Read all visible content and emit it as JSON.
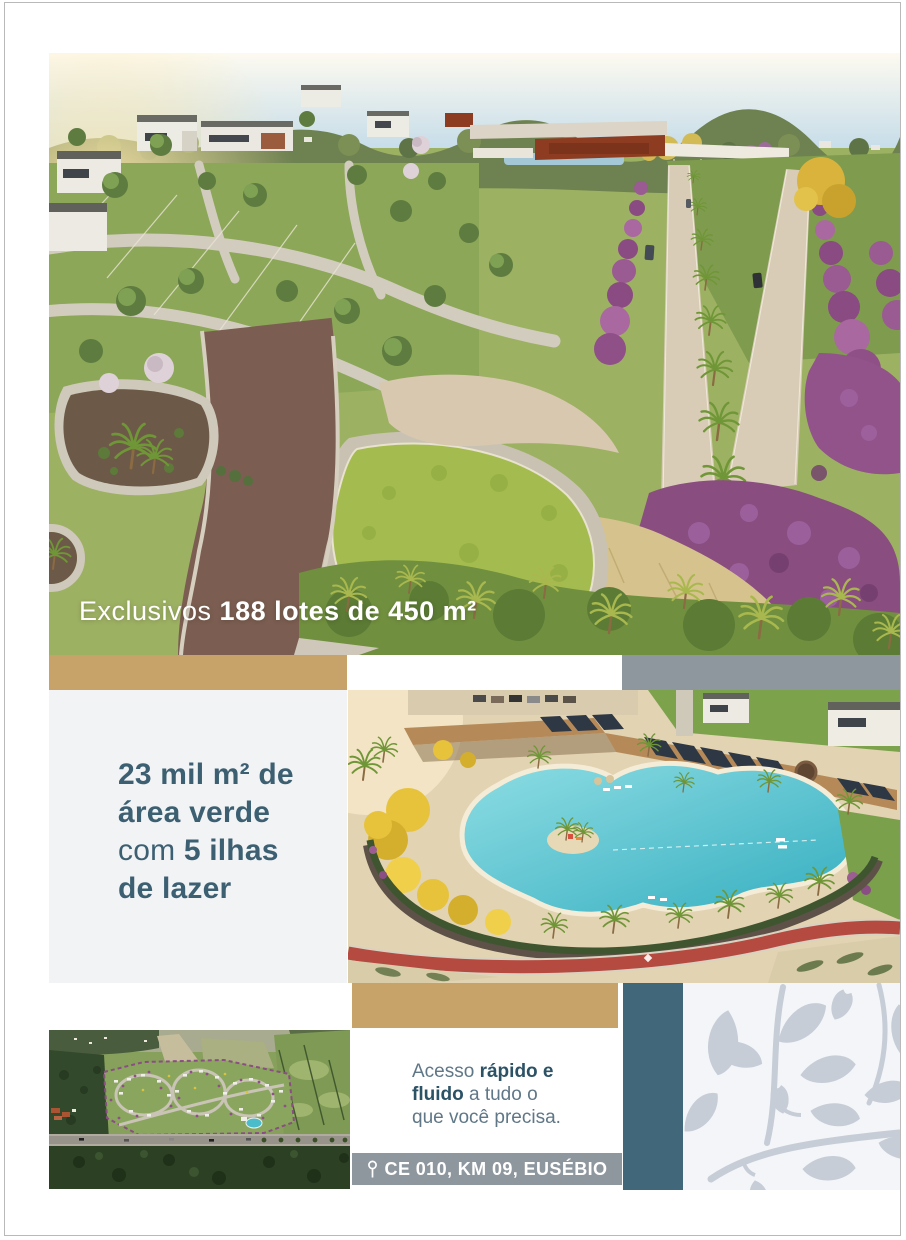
{
  "hero": {
    "caption_regular": "Exclusivos ",
    "caption_bold": "188 lotes de 450 m²"
  },
  "green_area": {
    "line1": "23 mil m² de",
    "line2": "área verde",
    "line3_light": "com ",
    "line3_bold": "5 ilhas",
    "line4": "de lazer"
  },
  "access": {
    "line1_regular": "Acesso ",
    "line1_bold": "rápido e",
    "line2_bold": "fluido",
    "line2_regular": " a tudo o",
    "line3_regular": "que você precisa."
  },
  "location": {
    "label": "CE 010, KM 09, EUSÉBIO",
    "pin_icon": "map-pin-icon"
  },
  "colors": {
    "gold": "#c7a369",
    "slate_gray_bar": "#8f979e",
    "teal_bar": "#41687a",
    "panel_light_gray": "#f2f3f5",
    "heading_teal": "#3c6072",
    "body_slate": "#5f7787",
    "body_teal_bold": "#2c5266",
    "caption_white": "#ffffff",
    "leaf_pattern_bg": "#f3f5f8",
    "leaf_pattern_fg": "#c6cdd7"
  }
}
